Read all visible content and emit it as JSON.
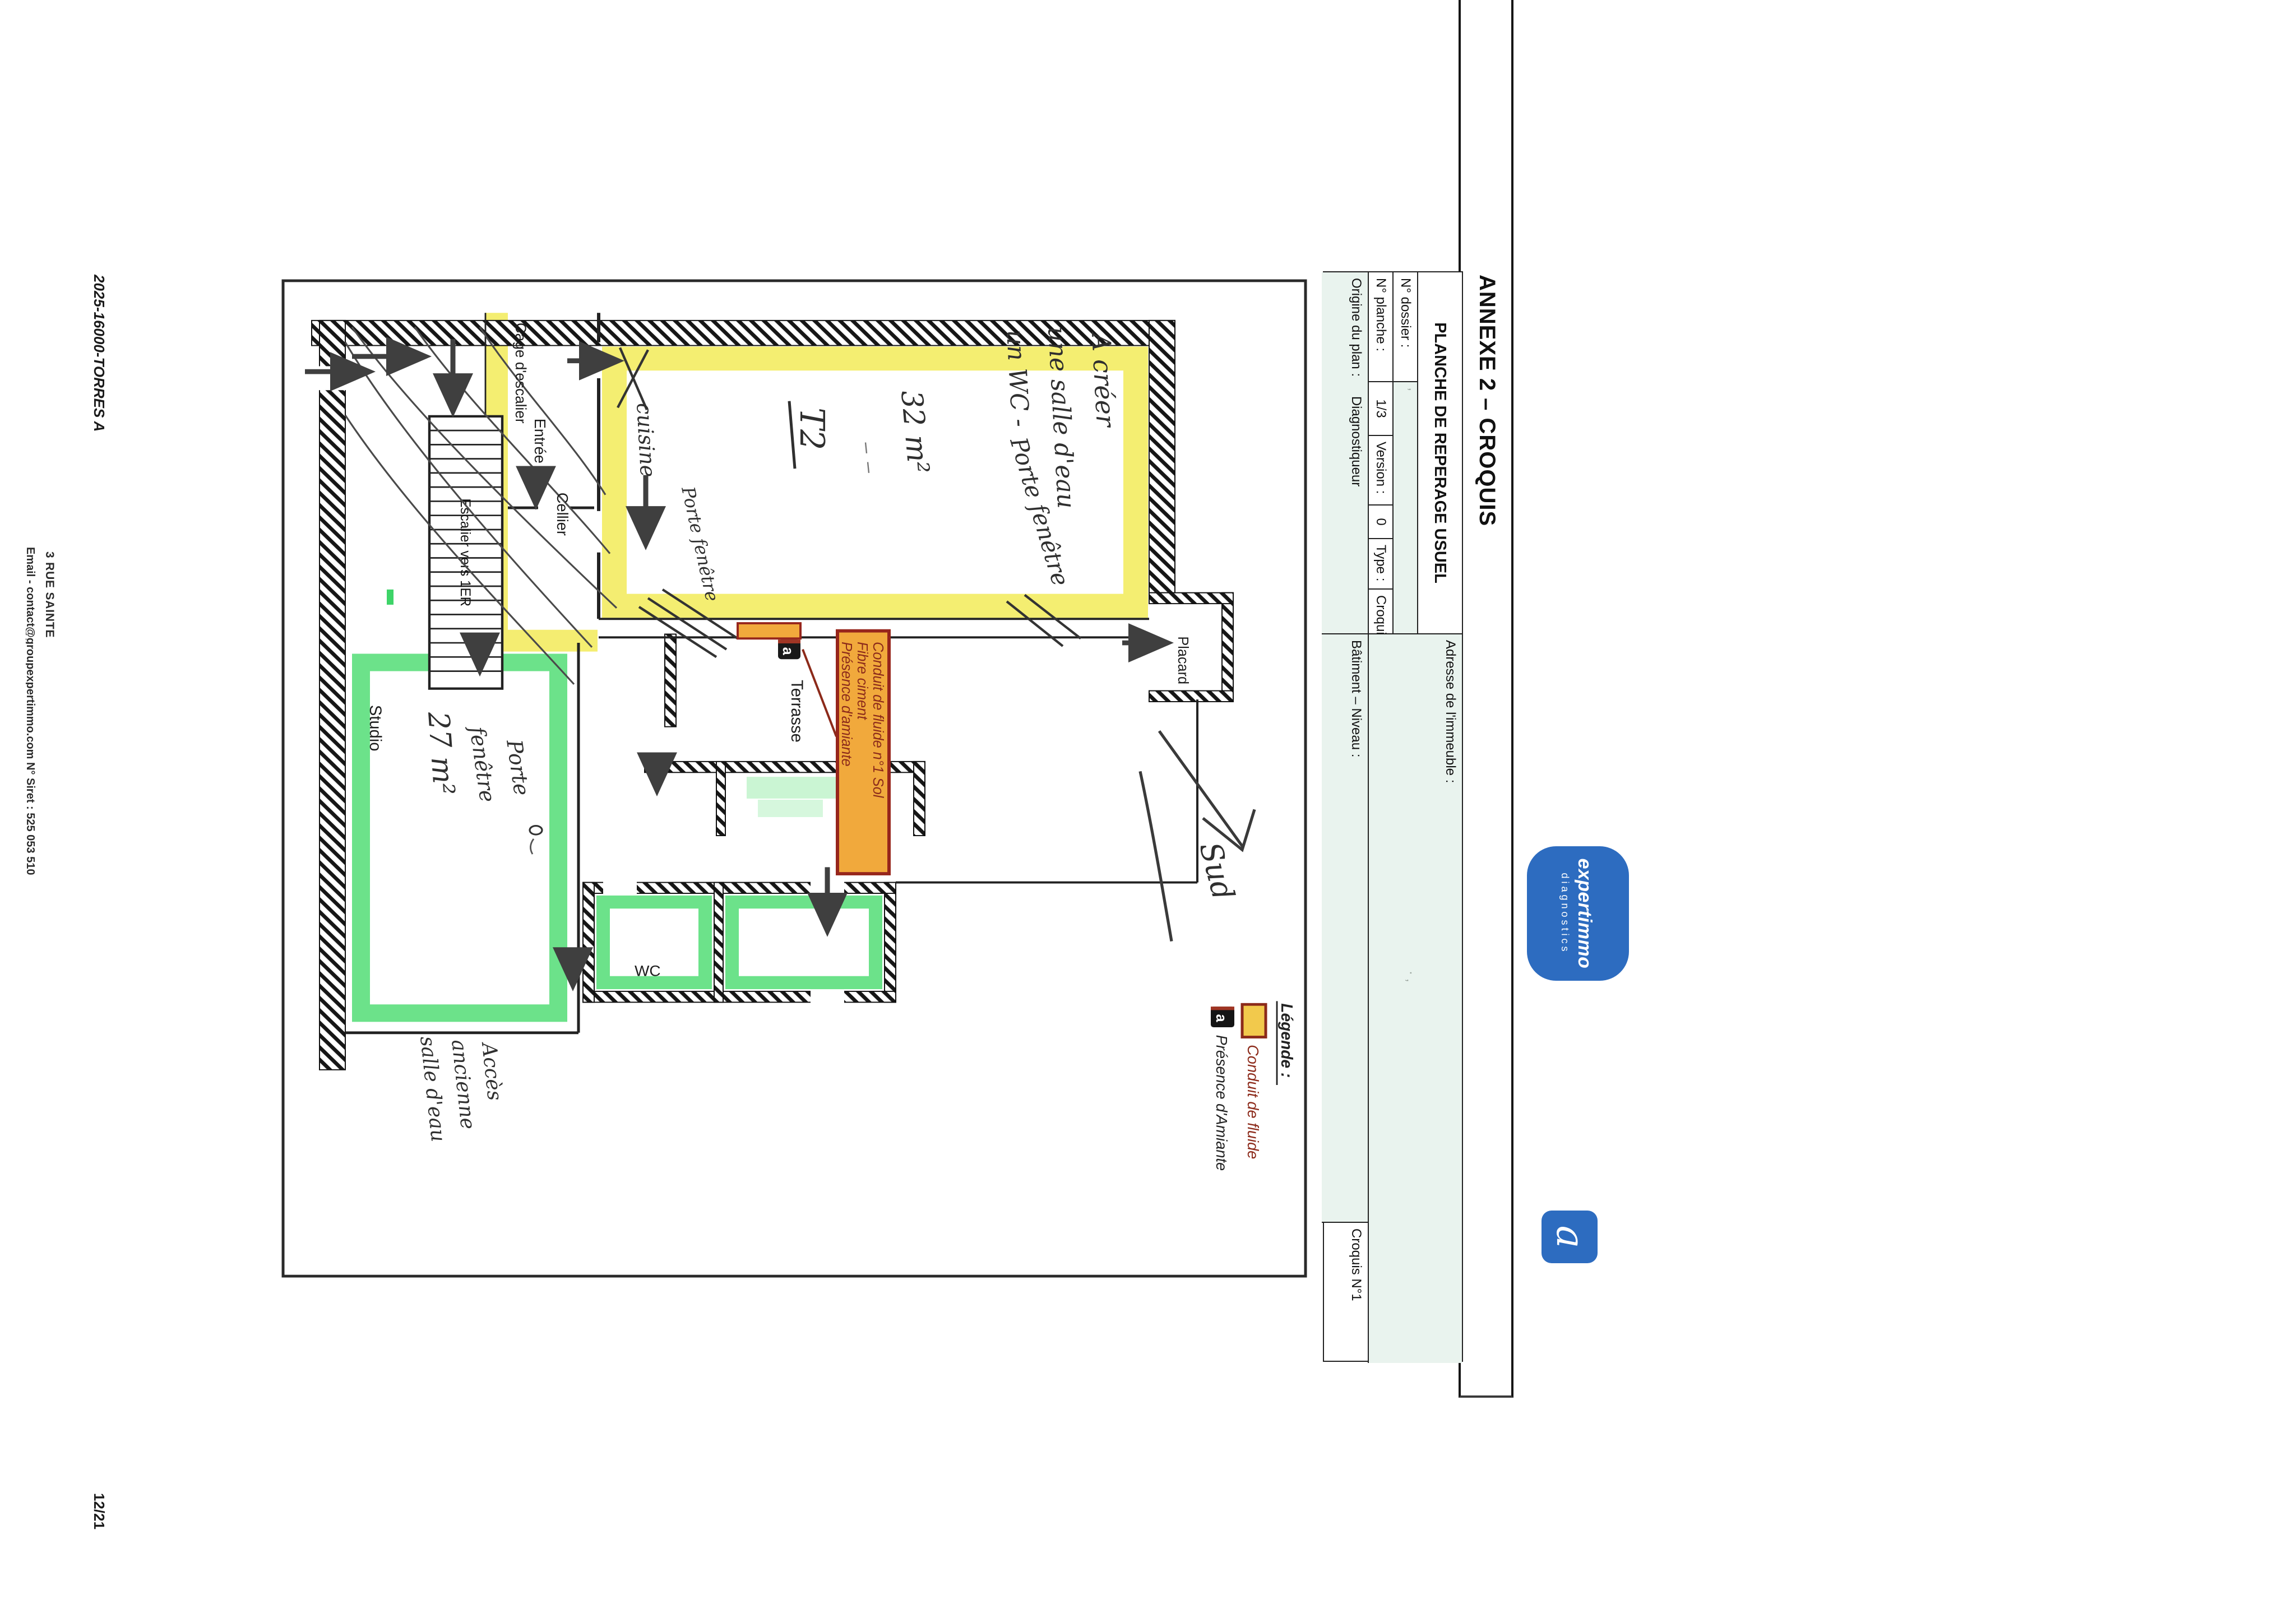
{
  "page": {
    "footer_left": "2025-16000-TORRES A",
    "page_number": "12/21",
    "caption": "Amiante",
    "footer_address_line": "3 RUE SAINTE",
    "footer_contact_line": "Email - contact@groupexpertimmo.com   N° Siret : 525 053 510"
  },
  "branding": {
    "logo_text": "expertimmo",
    "logo_subtext": "diagnostics",
    "badge_letter": "a"
  },
  "annexe": {
    "title": "ANNEXE 2 – CROQUIS"
  },
  "titleblock": {
    "header": "PLANCHE DE REPERAGE USUEL",
    "dossier_label": "N° dossier :",
    "dossier_value": "’",
    "planche_label": "N° planche :",
    "planche_value": "1/3",
    "version_label": "Version :",
    "version_value": "0",
    "type_label": "Type :",
    "type_value": "Croquis",
    "adresse_label": "Adresse de l'immeuble :",
    "adresse_value": "· ‚",
    "origine_label": "Origine du plan :",
    "origine_value": "Diagnostiqueur",
    "batiment_label": "Bâtiment – Niveau :",
    "batiment_value": "",
    "croquis_label": "Croquis N°1"
  },
  "plan": {
    "rooms": {
      "entree": "Entrée",
      "cage": "Cage d'escalier",
      "cellier": "Cellier",
      "escalier": "Escalier vers 1ER",
      "placard": "Placard",
      "terrasse": "Terrasse",
      "studio": "Studio",
      "wc": "WC"
    },
    "annotations": {
      "a_creer_1": "A créer",
      "a_creer_2": "une salle d'eau",
      "a_creer_3": "un WC -",
      "surface_t2": "32 m²",
      "type_t2": "T2",
      "cuisine": "cuisine",
      "porte_fenetre_big": "Porte fenêtre",
      "porte_fenetre_low": "Porte fenêtre",
      "pf_studio_l1": "Porte",
      "pf_studio_l2": "fenêtre",
      "surface_studio": "27 m²",
      "acces_1": "Accès",
      "acces_2": "ancienne",
      "acces_3": "salle d'eau",
      "sud": "Sud"
    },
    "marker_label": {
      "l1": "Conduit de fluide n°1 Sol",
      "l2": "Fibre ciment",
      "l3": "Présence d'amiante"
    },
    "marker_badge": "a",
    "legend": {
      "title": "Légende :",
      "item1": "Conduit de fluide",
      "item2": "Présence d'Amiante",
      "badge": "a"
    },
    "colors": {
      "highlight_yellow": "#f3ec62",
      "highlight_green": "#5cdf7d",
      "conduit_orange": "#f1a93c",
      "conduit_border": "#97261c",
      "marker_text": "#8c2a1a"
    }
  }
}
